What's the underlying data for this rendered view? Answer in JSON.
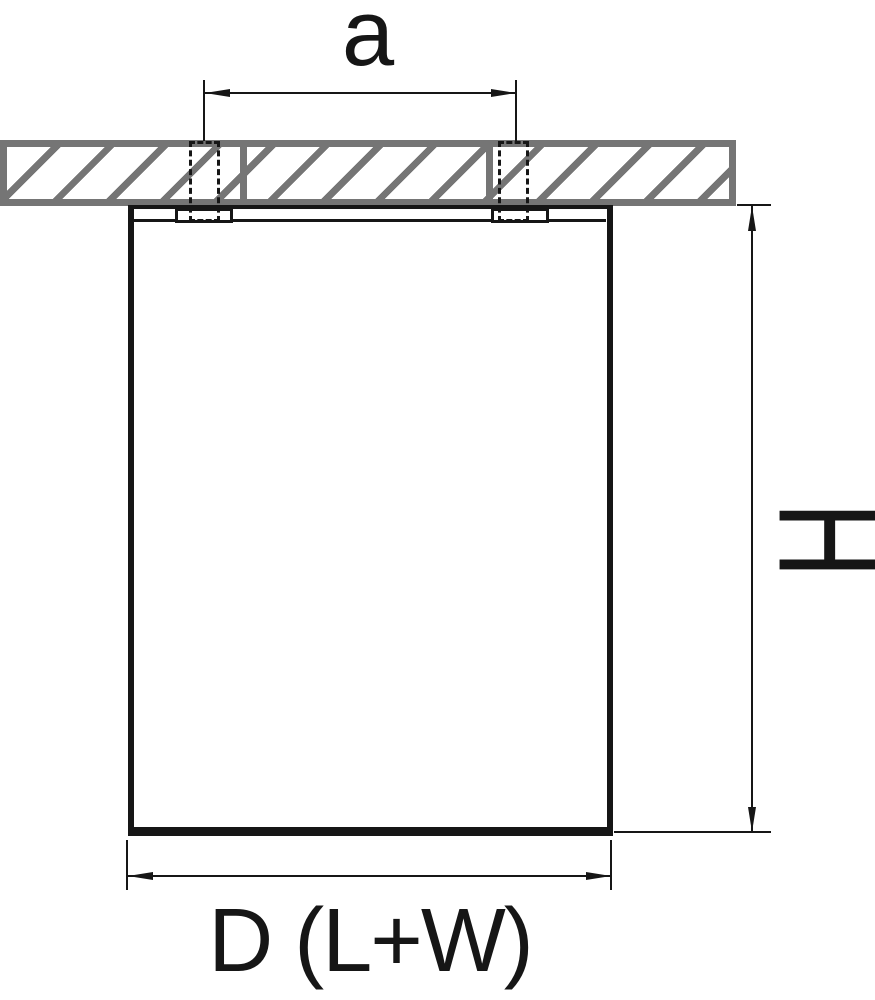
{
  "diagram": {
    "title": "ceiling-mount-fixture-dimension-diagram",
    "labels": {
      "top_dimension": "a",
      "height_dimension": "H",
      "bottom_dimension": "D (L+W)"
    },
    "colors": {
      "line": "#161616",
      "hatch_gray": "#757575",
      "background": "#ffffff"
    }
  }
}
